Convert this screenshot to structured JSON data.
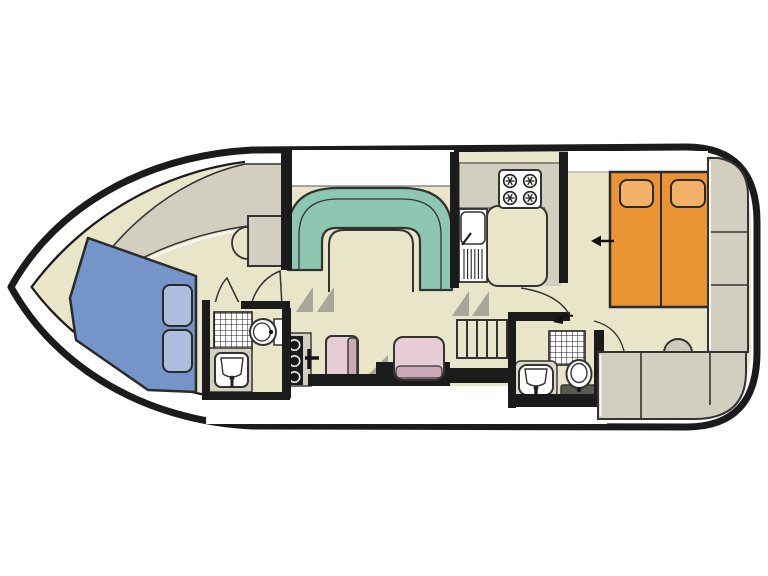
{
  "title": "Motor cruiser boat deck floor plan",
  "colors": {
    "paper": "#ffffff",
    "floor": "#e9e5c9",
    "cabinet": "#d2cfc0",
    "cabinet_light": "#dcd9ca",
    "wall": "#1b1b1b",
    "line": "#333333",
    "highlight": "#f6f5ef",
    "dinette_teal": "#8dc7b2",
    "vberth_blue": "#7594ca",
    "pillow_blue": "#abbedd",
    "bed_orange": "#eb9434",
    "pillow_orange": "#f2b166",
    "seat_pink": "#e6ccd5",
    "seat_pink_dark": "#c9a9b6",
    "shadow_gray": "#a8a59a",
    "stool_gray": "#cdcaba",
    "fixture_white": "#ffffff",
    "plate_gray": "#5a5a55"
  },
  "areas": {
    "bow_cabin": {
      "name": "bow-v-berth-cabin",
      "furniture": [
        "v-berth-double-bed",
        "two-pillows",
        "wardrobe-cabinets",
        "vanity-recess"
      ]
    },
    "bow_bathroom": {
      "name": "forward-bathroom",
      "furniture": [
        "shower-tray",
        "toilet",
        "washbasin-on-counter"
      ]
    },
    "saloon": {
      "name": "saloon",
      "furniture": [
        "u-shaped-dinette-sofa",
        "dinette-table",
        "helm-console-with-three-knobs",
        "throttle-lever",
        "helm-seat",
        "co-pilot-seat"
      ]
    },
    "galley": {
      "name": "galley",
      "furniture": [
        "four-burner-stove",
        "sink-with-drainer",
        "worktop-peninsula"
      ]
    },
    "companionway": {
      "name": "companionway-steps",
      "furniture": [
        "five-step-stairs"
      ]
    },
    "aft_bathroom": {
      "name": "aft-bathroom",
      "furniture": [
        "shower-tray",
        "washbasin",
        "toilet"
      ]
    },
    "aft_cabin": {
      "name": "aft-double-cabin",
      "furniture": [
        "double-bed-two-mattresses",
        "two-pillows",
        "dressing-stool",
        "vanity-cabinets",
        "wardrobe-cabinets",
        "entry-arrow"
      ]
    }
  },
  "counts": {
    "burners": 4,
    "stairs_steps": 5,
    "helm_knobs": 3,
    "bow_pillows": 2,
    "aft_pillows": 2
  }
}
